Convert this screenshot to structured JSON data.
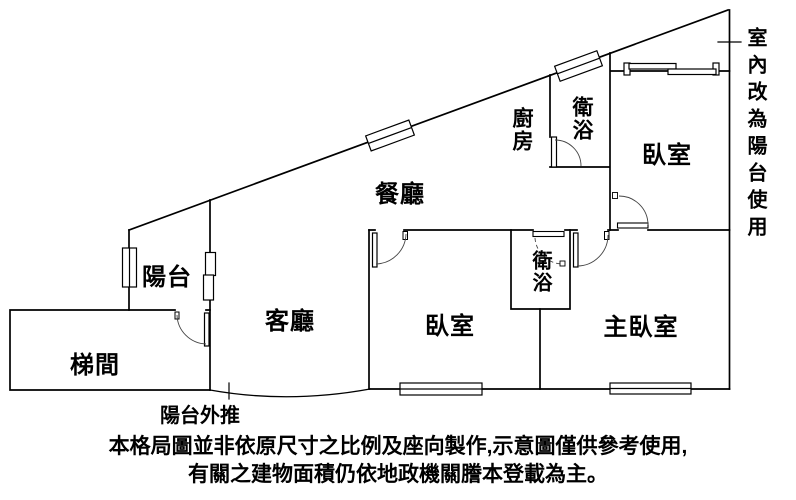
{
  "page": {
    "background_color": "#ffffff",
    "line_color": "#000000"
  },
  "floor_plan": {
    "rooms": [
      {
        "id": "balcony",
        "label": "陽台",
        "orientation": "horizontal"
      },
      {
        "id": "stairwell",
        "label": "梯間",
        "orientation": "horizontal"
      },
      {
        "id": "living-room",
        "label": "客廳",
        "orientation": "horizontal"
      },
      {
        "id": "dining-room",
        "label": "餐廳",
        "orientation": "horizontal"
      },
      {
        "id": "kitchen",
        "label": "廚房",
        "orientation": "vertical"
      },
      {
        "id": "bathroom-upper",
        "label": "衛浴",
        "orientation": "vertical"
      },
      {
        "id": "bedroom-upper",
        "label": "臥室",
        "orientation": "horizontal"
      },
      {
        "id": "bathroom-lower",
        "label": "衛浴",
        "orientation": "vertical"
      },
      {
        "id": "bedroom-lower",
        "label": "臥室",
        "orientation": "horizontal"
      },
      {
        "id": "master-bedroom",
        "label": "主臥室",
        "orientation": "horizontal"
      }
    ],
    "annotations": {
      "right_note": "室內改為陽台使用",
      "pushout_note": "陽台外推"
    }
  },
  "disclaimer": {
    "line1": "本格局圖並非依原尺寸之比例及座向製作,示意圖僅供參考使用,",
    "line2": "有關之建物面積仍依地政機關謄本登載為主。"
  }
}
